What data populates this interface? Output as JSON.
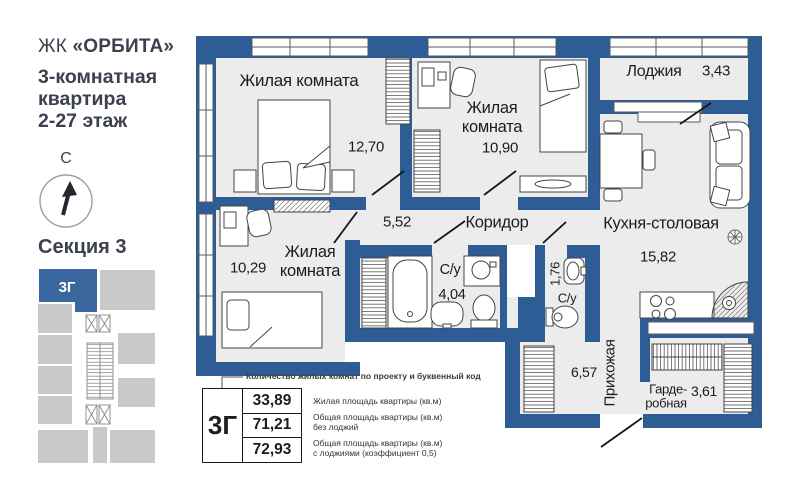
{
  "sidebar": {
    "brand_prefix": "ЖК",
    "brand_name": "«ОРБИТА»",
    "subtitle_lines": [
      "3-комнатная",
      "квартира",
      "2-27 этаж"
    ],
    "compass_north": "С",
    "section_title": "Секция 3",
    "section_unit_code": "3Г"
  },
  "plan": {
    "rooms": [
      {
        "id": "living-1",
        "name": "Жилая комната",
        "area": "12,70"
      },
      {
        "id": "living-2",
        "name": "Жилая комната",
        "area": "10,90"
      },
      {
        "id": "living-3",
        "name": "Жилая комната",
        "area": "10,29"
      },
      {
        "id": "loggia",
        "name": "Лоджия",
        "area": "3,43"
      },
      {
        "id": "corridor",
        "name": "Коридор",
        "area": "5,52"
      },
      {
        "id": "kitchen-dining",
        "name": "Кухня-столовая",
        "area": "15,82"
      },
      {
        "id": "bathroom",
        "name": "С/у",
        "area": "4,04"
      },
      {
        "id": "wc",
        "name": "С/у",
        "area": "1,76"
      },
      {
        "id": "entry-hall",
        "name": "Прихожая",
        "area": "6,57"
      },
      {
        "id": "wardrobe-room",
        "name": "Гардеробная",
        "area": "3,61",
        "name_lines": [
          "Гарде-",
          "робная"
        ]
      }
    ]
  },
  "legend": {
    "callout": "Количество жилых комнат по проекту и буквенный код",
    "unit_code": "3Г",
    "rows": [
      {
        "value": "33,89",
        "label": "Жилая площадь квартиры (кв.м)"
      },
      {
        "value": "71,21",
        "label": "Общая площадь квартиры (кв.м)\nбез лоджий"
      },
      {
        "value": "72,93",
        "label": "Общая площадь квартиры (кв.м)\nс лоджиями (коэффициент 0,5)"
      }
    ]
  },
  "colors": {
    "wall_blue": "#2e5d95",
    "room_fill": "#ececec",
    "section_gray": "#c9c9c9",
    "unit_blue": "#39679e",
    "text_dark": "#3b414d"
  }
}
